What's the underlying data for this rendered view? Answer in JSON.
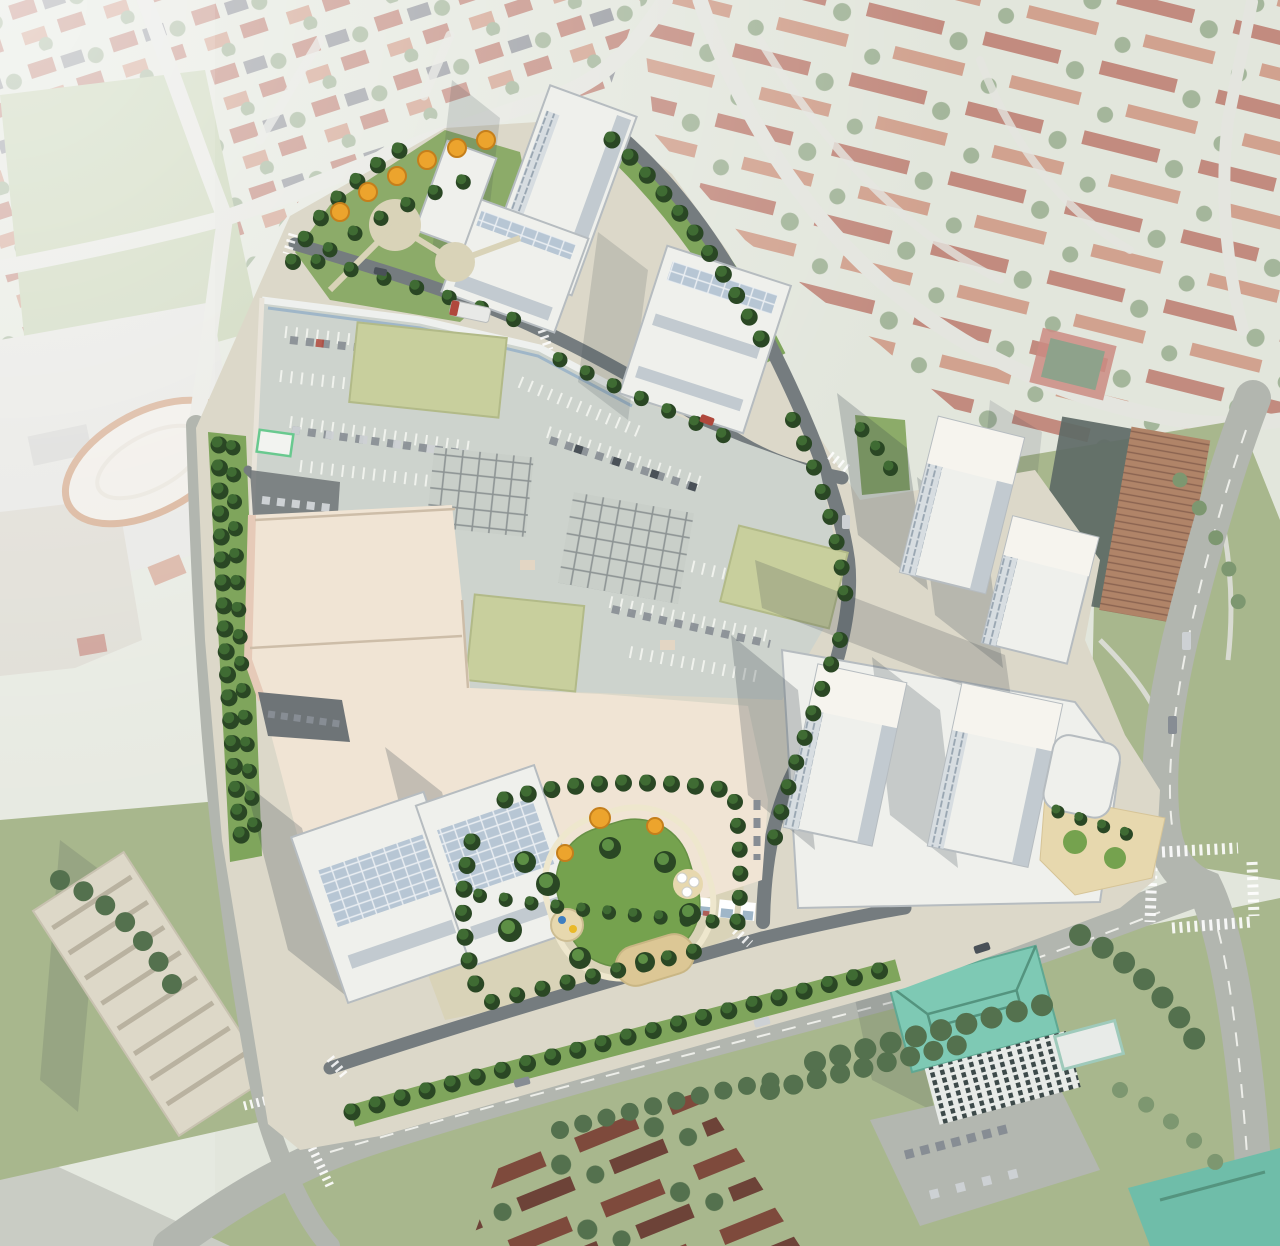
{
  "meta": {
    "kind": "aerial-architectural-rendering",
    "view": "birds-eye",
    "width": 1280,
    "height": 1246
  },
  "scene": {
    "development": {
      "label": "rendered mixed-use redevelopment site",
      "features": [
        "retail mall with rooftop parking deck",
        "painted parking stalls with cars",
        "rooftop skylight grids",
        "sage green roof panels",
        "street-level retail promenade",
        "central park with oval lawn",
        "sand play area",
        "playground and patio umbrellas",
        "white residential towers on podiums",
        "mid-rise apartment blocks",
        "pocket park with orange autumn trees",
        "tree-lined internal streets",
        "transit bus on internal street"
      ]
    },
    "context": {
      "label": "faded aerial photo surroundings",
      "features": [
        "detached houses with red roofs",
        "townhouse crescents",
        "green sports field",
        "arena with oval roof",
        "school buildings",
        "existing apartment slab",
        "existing brick apartment tower",
        "teal-roof condo towers",
        "tennis court",
        "arterial avenues with lane markings",
        "signalized intersection with crosswalks",
        "dense ravine trees"
      ]
    }
  },
  "colors": {
    "photoBase": "#d6dbcd",
    "photoRoad": "#d8dad2",
    "avenue": "#b2b6af",
    "laneLine": "#edeee9",
    "fieldGreen": "#aebf93",
    "lawnPhoto": "#a8b78d",
    "photoTree": "#7d9770",
    "photoTreeDark": "#54714e",
    "roofRed": "#a85a48",
    "roofRedLight": "#bd7a5f",
    "roofDark": "#6b6f78",
    "roofMaroon": "#7e4a3c",
    "roofMaroon2": "#6d4338",
    "arenaRoof": "#e7e3d8",
    "arenaRing": "#bb7748",
    "industrial": "#d7d7d1",
    "school": "#c9c4b6",
    "slabBeige": "#ddd8c8",
    "brick": "#b08468",
    "brickShade": "#5e6a66",
    "tealRoof": "#7ec9b4",
    "tealRoofDark": "#6fbda9",
    "photoParking": "#b3b7b0",
    "siteGround": "#dcd8c9",
    "roadDark": "#757c7f",
    "sidewalk": "#d8d3c2",
    "vergeGreen": "#7fa55c",
    "parkGround": "#d9d3b8",
    "lawnPark": "#75a24e",
    "sand": "#dcc795",
    "sandLight": "#e7d8ae",
    "deck": "#cdd3cd",
    "deckLine": "#f3f5f0",
    "gridFill": "#c9cfc9",
    "gridLine": "#8d9494",
    "carGray": "#878d94",
    "carWhite": "#cdd1d4",
    "carDark": "#4a5158",
    "carRed": "#b0483c",
    "greenRoof": "#c8cf9d",
    "greenRoofEdge": "#b2ba88",
    "cream": "#f0e4d4",
    "pinkFacade": "#e6cab8",
    "roofEdge": "#cdbda8",
    "serviceAsphalt": "#6e7477",
    "bldgWhite": "#eff0ec",
    "bldgShade": "#c2cad0",
    "panelBlue": "#b7c6d4",
    "winLine": "#98a5b1",
    "parapet": "#b6bcc0",
    "glassBlue": "#9fb6c8",
    "treeDark": "#2a4724",
    "tree": "#3f6b33",
    "treeLight": "#5d8f45",
    "orangeTree": "#eca42d",
    "orangeDark": "#c57f1b",
    "shadow": "#37434d",
    "white": "#ffffff",
    "canopyGreen": "#69c98f",
    "playBlue": "#3f7fc1",
    "playYellow": "#e9b929"
  }
}
